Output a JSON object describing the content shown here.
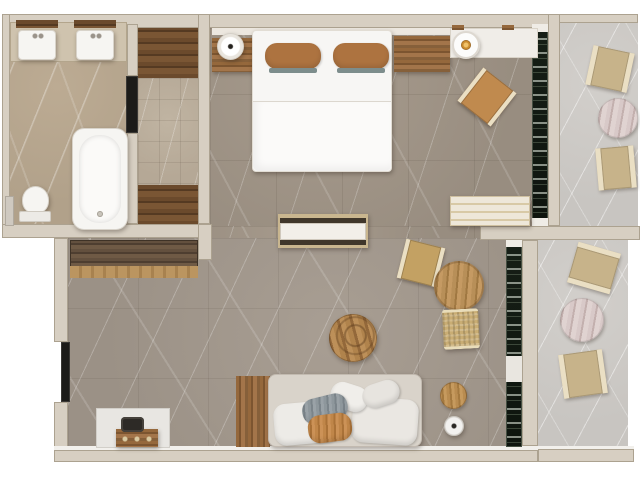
{
  "title": "Hotel suite floor plan (top-down render)",
  "colors": {
    "outside": "#ffffff",
    "wall": "#d7cfc2",
    "wall_edge": "#aca290",
    "bath_floor": "#b1a18a",
    "hall_tile": "#b5a896",
    "room_floor": "#988d80",
    "living_floor": "#9b9186",
    "balcony_floor": "#c8c5c1",
    "glass": "#0e140e",
    "wood_dark": "#5e432a",
    "wood_mid": "#8f6138",
    "wood_light": "#b08347",
    "white_fixture": "#f6f5f2",
    "sofa": "#d9d3ca",
    "pillow_tan": "#ad7340",
    "chair_tan": "#c08a4e",
    "chair_frame": "#eadfc4",
    "balcony_chair": "#c7b38a",
    "balcony_table": "#cfbdbd",
    "lamp_amber": "#c98a2e"
  },
  "legend": {
    "floor-plan": "Apartment floor plan",
    "bathroom-floor": "Bathroom",
    "vanity-counter": "Vanity counter",
    "sink-left": "Sink",
    "sink-right": "Sink",
    "mirror-left": "Mirror",
    "mirror-right": "Mirror",
    "bathtub": "Bathtub",
    "toilet": "Toilet",
    "toiletry-shelf": "Toiletry shelf",
    "bathroom-door": "Bathroom door",
    "hallway-floor": "Hallway",
    "hall-wardrobe-top": "Wardrobe",
    "hall-wardrobe-bottom": "Wardrobe",
    "bedroom-floor": "Bedroom",
    "double-bed": "Double bed",
    "pillow-left": "Pillow",
    "pillow-right": "Pillow",
    "nightstand-left": "Nightstand",
    "nightstand-right": "Nightstand",
    "table-lamp": "Table lamp",
    "vanity-desk": "Desk",
    "pendant-lamp": "Pendant lamp",
    "bedroom-chair": "Lounge chair",
    "luggage-bench": "Bench",
    "media-console": "Media console",
    "bedroom-window": "Window",
    "living-room-floor": "Living room",
    "sideboard": "Sideboard",
    "sofa": "Sofa",
    "sofa-wood-panel": "Wood floor panel",
    "coffee-table": "Coffee table",
    "dining-chair": "Dining chair",
    "dining-table": "Dining table",
    "wicker-chair": "Wicker chair",
    "side-table": "Side table",
    "stool": "Stool",
    "alcove-mat": "Alcove",
    "luggage-chest": "Luggage chest",
    "bag": "Bag",
    "entry-door": "Entry door",
    "living-window": "Window",
    "balcony-top-floor": "Balcony",
    "balcony-bottom-floor": "Balcony",
    "balcony-chair": "Balcony chair",
    "balcony-table": "Balcony table"
  },
  "rooms": {
    "bathroom": {
      "items": [
        "double vanity with two sinks",
        "bathtub",
        "toilet"
      ]
    },
    "hallway": {
      "items": [
        "wardrobe (top)",
        "wardrobe (bottom)"
      ]
    },
    "bedroom": {
      "items": [
        "double bed with two tan pillows",
        "nightstand with lamp (left)",
        "nightstand (right)",
        "desk with pendant lamp",
        "lounge chair",
        "luggage bench",
        "media console"
      ]
    },
    "living_room": {
      "items": [
        "sideboard",
        "sofa with six pillows",
        "round coffee table",
        "round dining table",
        "two dining chairs",
        "side table",
        "stool",
        "luggage chest on mat"
      ]
    },
    "balcony_top": {
      "items": [
        "two chairs",
        "round marble table"
      ]
    },
    "balcony_bottom": {
      "items": [
        "two chairs",
        "round marble table"
      ]
    }
  }
}
